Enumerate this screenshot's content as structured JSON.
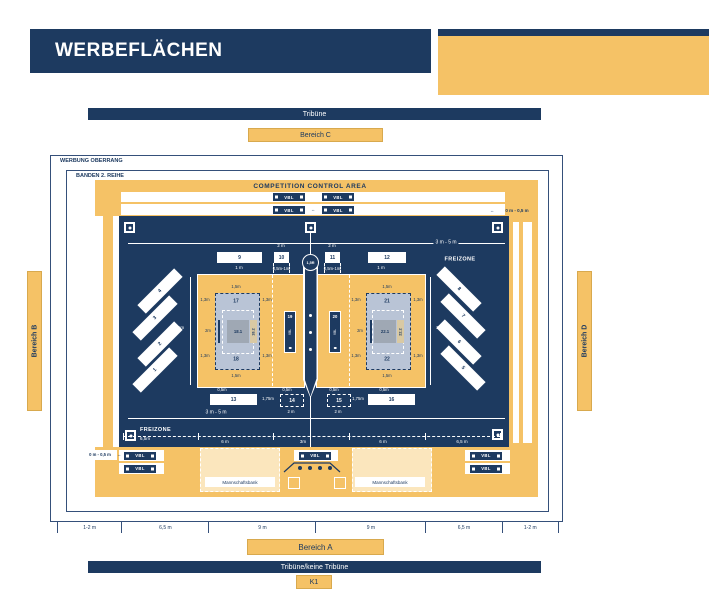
{
  "title": "WERBEFLÄCHEN",
  "legend_format": {
    "title": "FLÄCHENFORMAT",
    "rows": [
      {
        "label": "klein",
        "value": "2m x 1m"
      },
      {
        "label": "normal",
        "value": "3,4m x 1m"
      },
      {
        "label": "groß Hinterfeld",
        "value": "3,4m x 2m"
      },
      {
        "label": "Werbebandenformat",
        "value": "3m x 1m"
      }
    ]
  },
  "legend_colors": {
    "title": "FLÄCHENFARBEN",
    "rows": [
      {
        "label": "weiß",
        "desc": "nutzbare Werbefläche"
      },
      {
        "label": "blau - blau gestrichelt",
        "desc": "2 Werbeflächen im Hinterfeld"
      },
      {
        "label": "blau - weiß gestrichelt",
        "desc": "1 Werbefläche statt 2 im Hinterfeld"
      },
      {
        "label": "blau",
        "desc": "VBL-Fläche"
      },
      {
        "label": "gelb",
        "desc": "Spielfeld"
      }
    ]
  },
  "stands": {
    "top": "Tribüne",
    "bottom": "Tribüne/keine Tribüne",
    "k1": "K1"
  },
  "bereiche": {
    "a": "Bereich A",
    "b": "Bereich B",
    "c": "Bereich C",
    "d": "Bereich D"
  },
  "frames": {
    "outer": "WERBUNG OBERRANG",
    "inner": "BANDEN 2. REIHE"
  },
  "arena": {
    "cca": "COMPETITION CONTROL AREA",
    "freizone": "FREIZONE",
    "vbl": "VBL",
    "bench": "Mannschaftsbank"
  },
  "adboxes": {
    "top": [
      "9",
      "10",
      "11",
      "12"
    ],
    "bottom": [
      "13",
      "14",
      "15",
      "16"
    ],
    "net": [
      "19",
      "20"
    ],
    "left_diagonal": [
      "4",
      "3",
      "2",
      "1"
    ],
    "right_diagonal": [
      "8",
      "7",
      "6",
      "5"
    ],
    "hinterfeld_left": {
      "top": "17",
      "bottom": "18",
      "center": "18.1",
      "side": "18.2"
    },
    "hinterfeld_right": {
      "top": "21",
      "bottom": "22",
      "center": "22.1",
      "side": "22.2"
    }
  },
  "dims": {
    "m0_1": "0 m - 1 m",
    "m0_05": "0 m - 0,5 m",
    "m3_5": "3 m - 5 m",
    "m2": "2 m",
    "m1": "1 m",
    "m1c": "1m",
    "m05_1": "0,5m-1m",
    "r15": "1,5R",
    "m15": "1,5m",
    "m13": "1,3m",
    "m2c": "2m",
    "m05": "0,5m",
    "m175": "1,75m",
    "m65": "6,5m",
    "arrow_h": "↔",
    "arrow_v": "↕"
  },
  "bottom_scale": [
    "1-2 m",
    "6,5 m",
    "9 m",
    "9 m",
    "6,5 m",
    "1-2 m"
  ],
  "court_scale": [
    "6,5m",
    "6 m",
    "3m",
    "6 m",
    "6,5 m"
  ],
  "colors": {
    "navy": "#1d3a60",
    "yellow": "#f5c266",
    "cream": "#fbe6bd",
    "lightblue": "#b9c4d6",
    "gray": "#9fa8b4",
    "tan": "#d9c9a3"
  }
}
